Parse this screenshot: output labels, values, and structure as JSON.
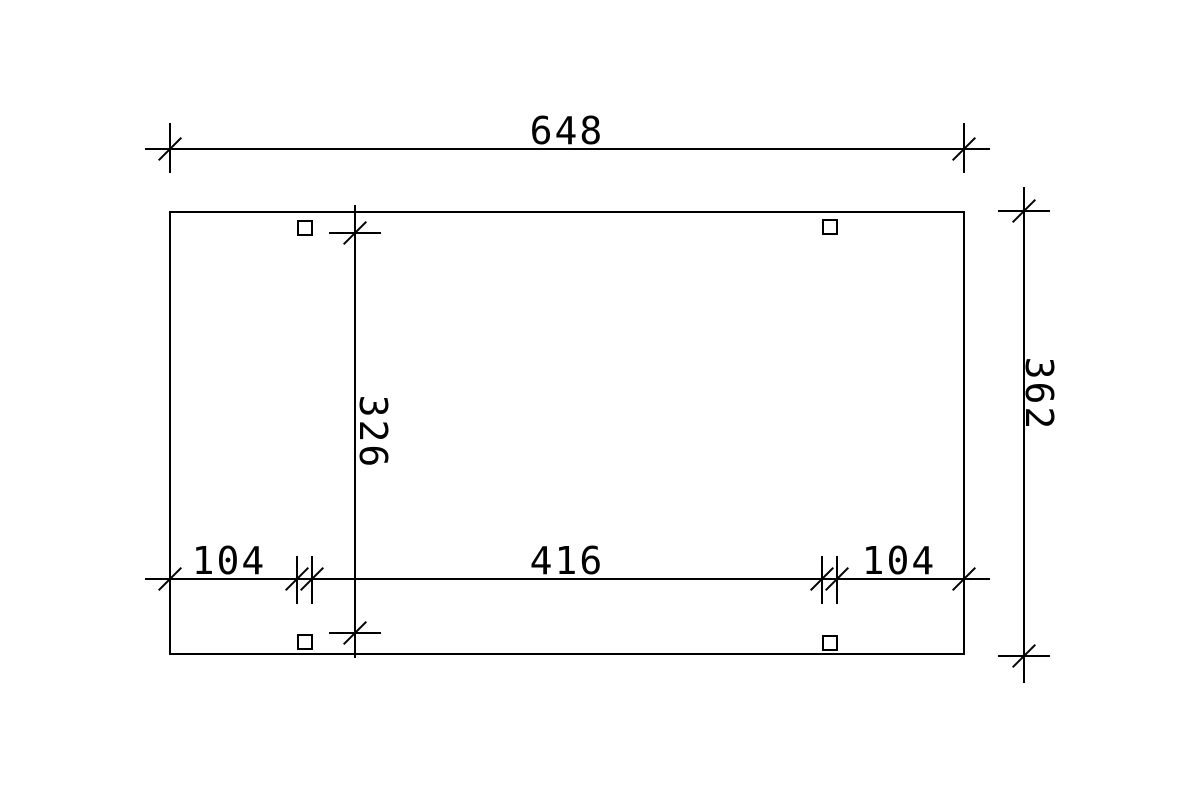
{
  "drawing": {
    "background_color": "#ffffff",
    "line_color": "#000000",
    "labels": {
      "total_width": "648",
      "total_depth": "362",
      "inner_post_depth": "326",
      "bottom_left_segment": "104",
      "bottom_middle_segment": "416",
      "bottom_right_segment": "104"
    }
  }
}
